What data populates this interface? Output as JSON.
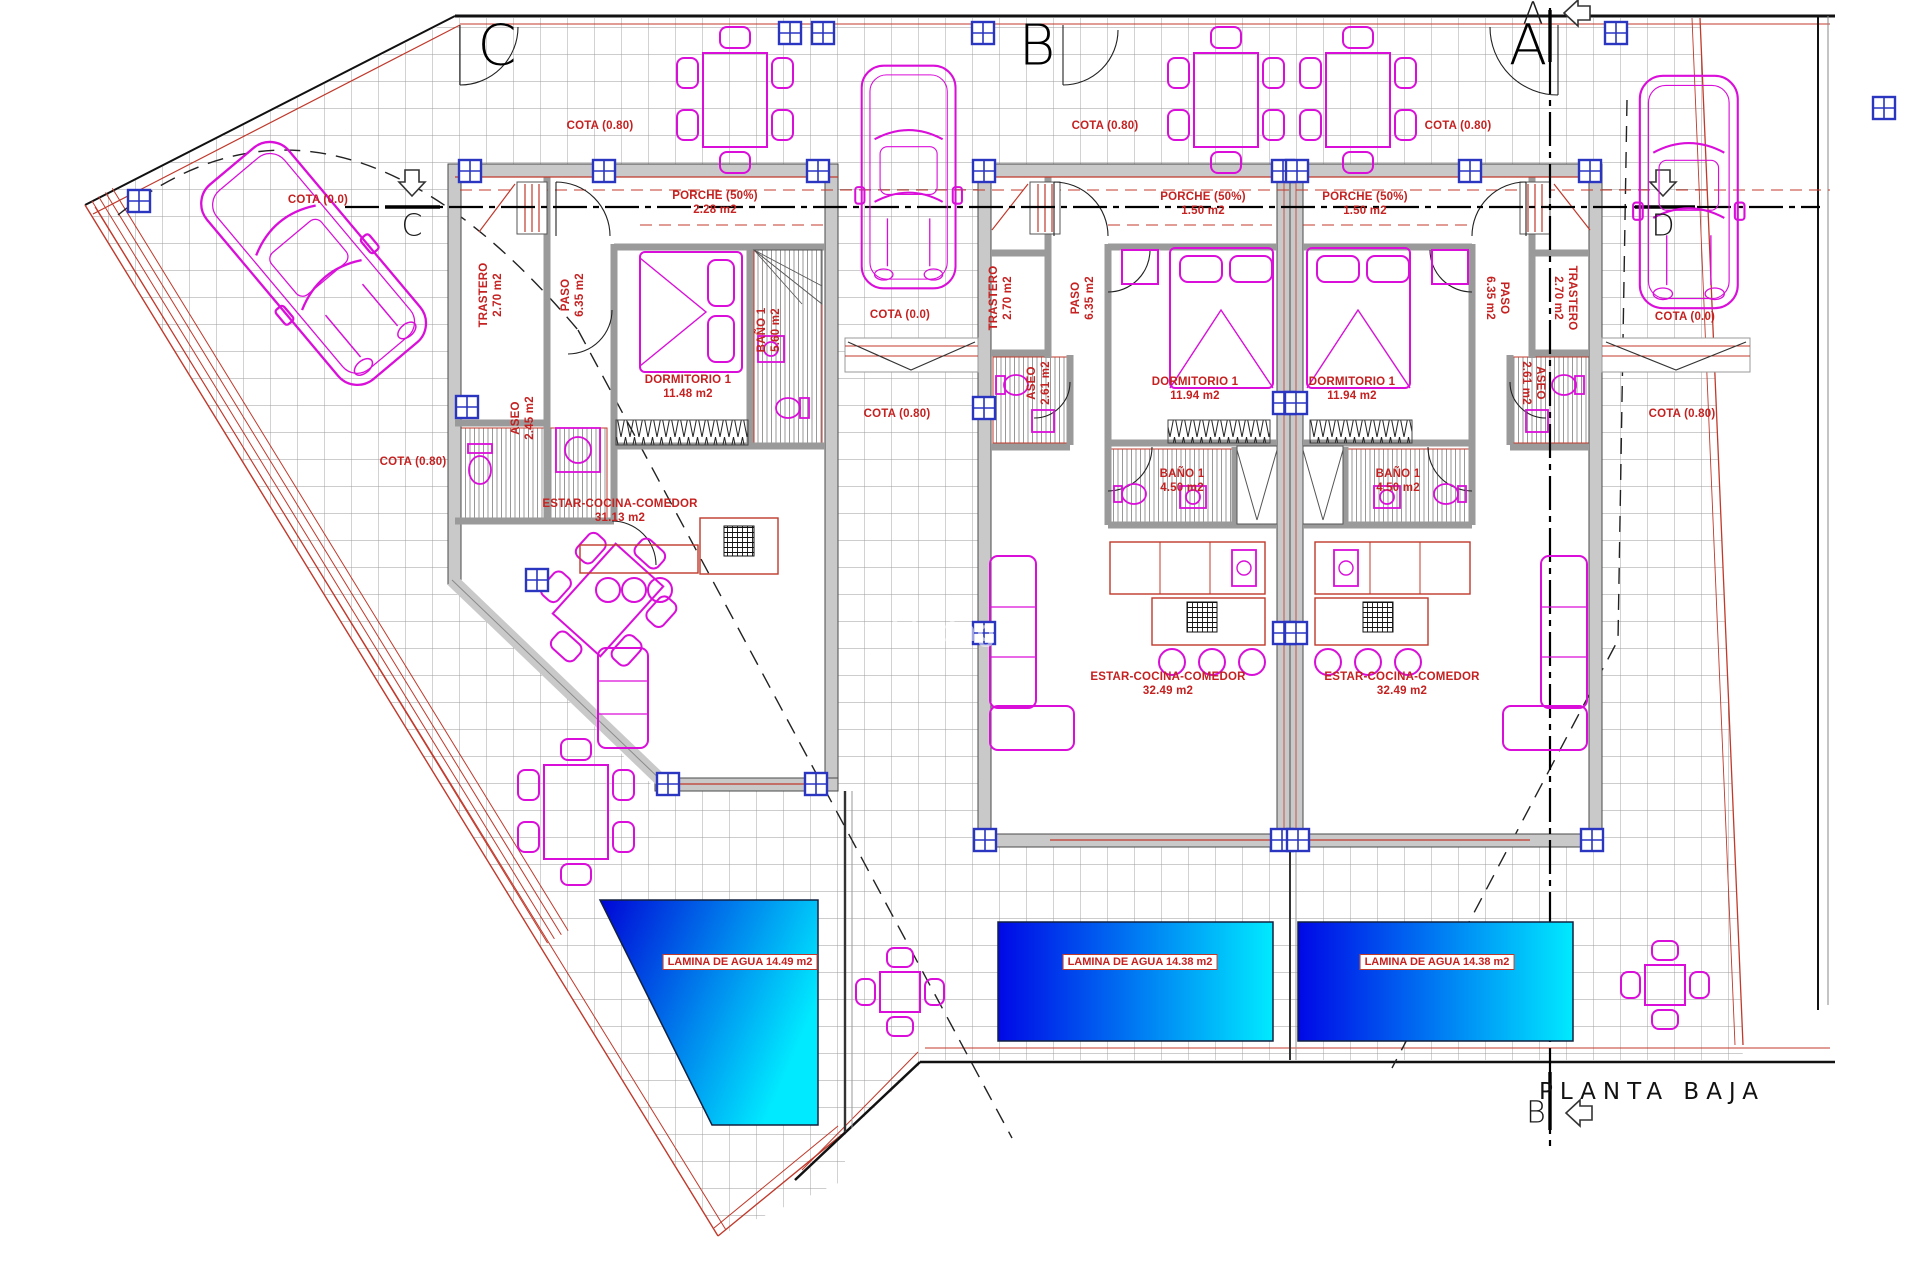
{
  "plan": {
    "title": "PLANTA BAJA",
    "watermark": "y Listing",
    "colors": {
      "label_red": "#c42120",
      "boundary_red": "#c0392b",
      "wall_gray": "#c9c9c9",
      "furniture_magenta": "#d90fd9",
      "window_blue": "#2a35c0",
      "pool_deep_blue": "#0007dc",
      "pool_cyan": "#00eaff"
    },
    "section_markers": {
      "top_right": "A",
      "bottom_right": "B",
      "left": "C",
      "right": "D"
    },
    "units": [
      {
        "id": "villa-c",
        "letter": "C",
        "rooms": {
          "trastero": {
            "label": "TRASTERO",
            "area": "2.70 m2"
          },
          "paso": {
            "label": "PASO",
            "area": "6.35 m2"
          },
          "aseo": {
            "label": "ASEO",
            "area": "2.45 m2"
          },
          "dormitorio": {
            "label": "DORMITORIO 1",
            "area": "11.48 m2"
          },
          "bano": {
            "label": "BAÑO 1",
            "area": "5.60 m2"
          },
          "porche": {
            "label": "PORCHE (50%)",
            "area": "2.28 m2"
          },
          "estar": {
            "label": "ESTAR-COCINA-COMEDOR",
            "area": "31.13 m2"
          }
        },
        "cotas": {
          "terrace": "COTA (0.80)",
          "driveway": "COTA (0.0)",
          "garden": "COTA (0.80)"
        },
        "pool_label": "LAMINA DE AGUA 14.49 m2"
      },
      {
        "id": "villa-b",
        "letter": "B",
        "rooms": {
          "trastero": {
            "label": "TRASTERO",
            "area": "2.70 m2"
          },
          "paso": {
            "label": "PASO",
            "area": "6.35 m2"
          },
          "aseo": {
            "label": "ASEO",
            "area": "2.61 m2"
          },
          "dormitorio": {
            "label": "DORMITORIO 1",
            "area": "11.94 m2"
          },
          "bano": {
            "label": "BAÑO 1",
            "area": "4.50 m2"
          },
          "porche": {
            "label": "PORCHE (50%)",
            "area": "1.50 m2"
          },
          "estar": {
            "label": "ESTAR-COCINA-COMEDOR",
            "area": "32.49 m2"
          }
        },
        "cotas": {
          "driveway": "COTA (0.0)",
          "terrace": "COTA (0.80)",
          "side": "COTA (0.80)"
        },
        "pool_label": "LAMINA DE AGUA 14.38 m2"
      },
      {
        "id": "villa-a",
        "letter": "A",
        "rooms": {
          "trastero": {
            "label": "TRASTERO",
            "area": "2.70 m2"
          },
          "paso": {
            "label": "PASO",
            "area": "6.35 m2"
          },
          "aseo": {
            "label": "ASEO",
            "area": "2.61 m2"
          },
          "dormitorio": {
            "label": "DORMITORIO 1",
            "area": "11.94 m2"
          },
          "bano": {
            "label": "BAÑO 1",
            "area": "4.50 m2"
          },
          "porche": {
            "label": "PORCHE (50%)",
            "area": "1.50 m2"
          },
          "estar": {
            "label": "ESTAR-COCINA-COMEDOR",
            "area": "32.49 m2"
          }
        },
        "cotas": {
          "terrace": "COTA (0.80)",
          "driveway": "COTA (0.0)",
          "garden": "COTA (0.80)"
        },
        "pool_label": "LAMINA DE AGUA 14.38 m2"
      }
    ]
  }
}
